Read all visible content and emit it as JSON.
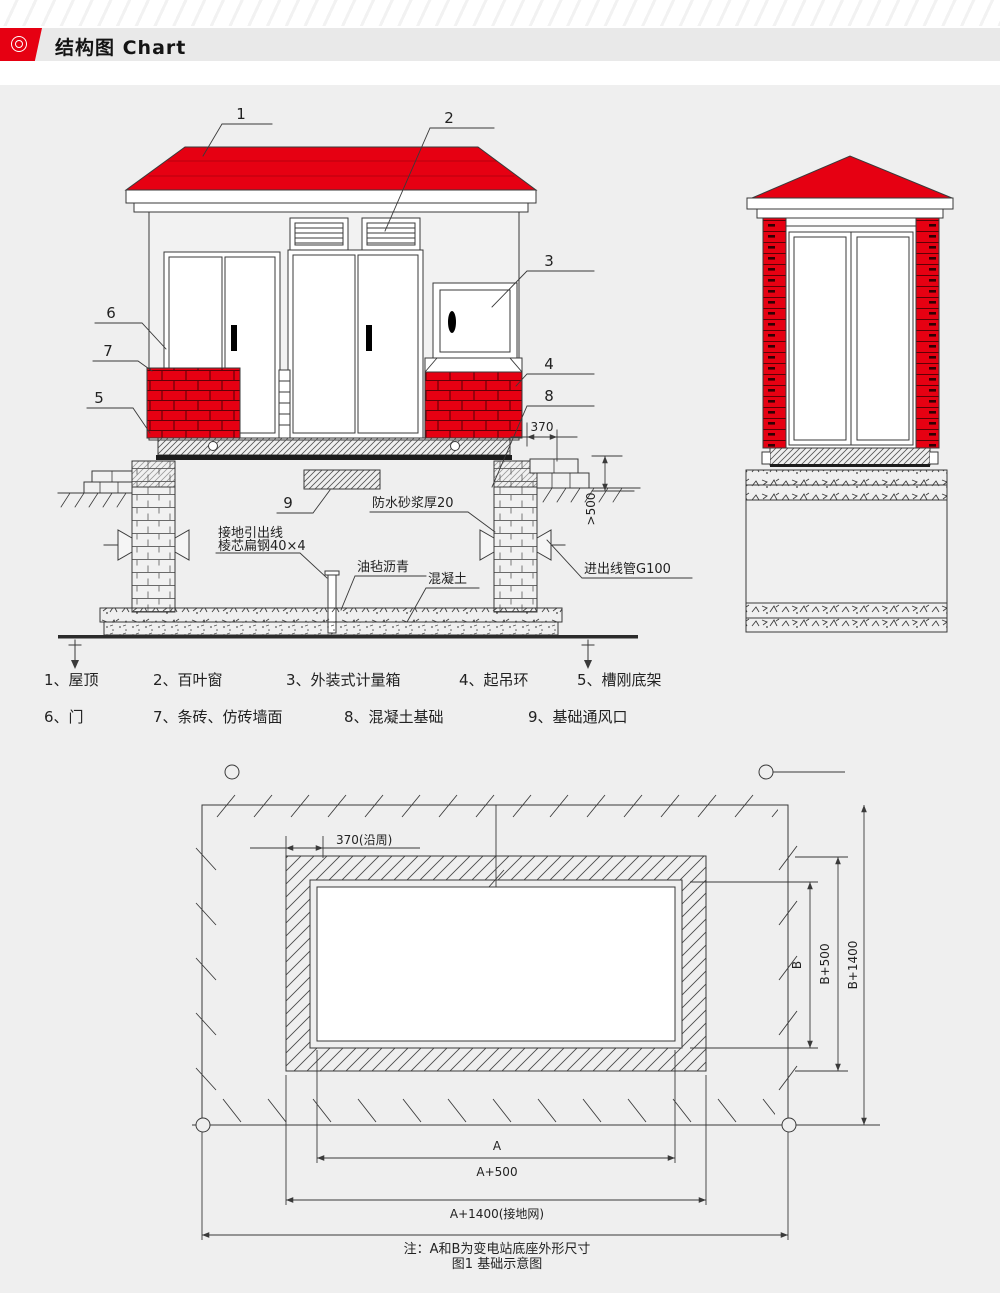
{
  "header": {
    "title": "结构图 Chart",
    "icon": "target-icon"
  },
  "front": {
    "callouts": [
      "1",
      "2",
      "3",
      "4",
      "5",
      "6",
      "7",
      "8",
      "9"
    ],
    "dim_370": "370",
    "dim_gt500": ">500",
    "ann_waterproof": "防水砂浆厚20",
    "ann_ground1": "接地引出线",
    "ann_ground2": "棱芯扁钢40×4",
    "ann_asphalt": "油毡沥青",
    "ann_concrete": "混凝土",
    "ann_conduit": "进出线管G100"
  },
  "legend": {
    "items": [
      "1、屋顶",
      "2、百叶窗",
      "3、外装式计量箱",
      "4、起吊环",
      "5、槽刚底架",
      "6、门",
      "7、条砖、仿砖墙面",
      "8、混凝土基础",
      "9、基础通风口"
    ]
  },
  "plan": {
    "dim_370": "370(沿周)",
    "dim_b": "B",
    "dim_b500": "B+500",
    "dim_b1400": "B+1400",
    "dim_a": "A",
    "dim_a500": "A+500",
    "dim_a1400": "A+1400(接地网)",
    "note": "注：A和B为变电站底座外形尺寸",
    "caption": "图1 基础示意图"
  },
  "colors": {
    "accent_red": "#e60012",
    "line": "#3a3a3a",
    "bg": "#efefef"
  }
}
